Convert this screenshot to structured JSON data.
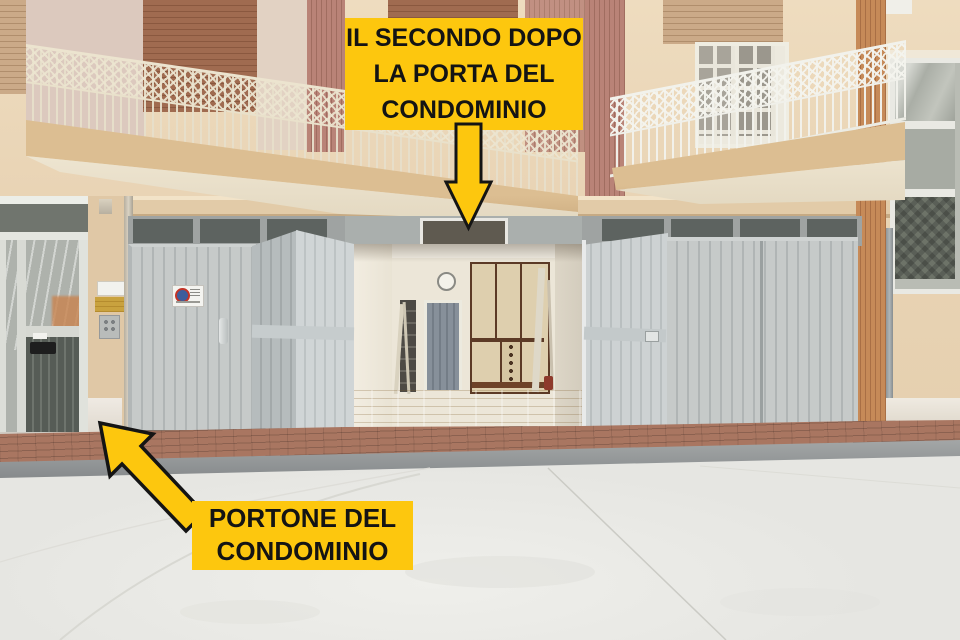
{
  "annotations": {
    "top_label": {
      "lines": [
        "IL SECONDO DOPO",
        "LA PORTA DEL",
        "CONDOMINIO"
      ]
    },
    "bottom_label": {
      "lines": [
        "PORTONE DEL",
        "CONDOMINIO"
      ]
    },
    "style": {
      "label_bg": "#fdc70e",
      "label_text": "#141414",
      "arrow_fill": "#fdc70e",
      "arrow_outline": "#141414"
    },
    "icons": {
      "top_arrow": "down-arrow-icon",
      "bottom_arrow": "up-left-arrow-icon"
    }
  },
  "scene": {
    "colors": {
      "facade": "#e9d4b5",
      "garage_door": "#c5c9c9",
      "shutter_brown": "#9e6a50",
      "brick_sidewalk": "#a97661",
      "concrete": "#e8e8e4",
      "wood_floor": "#c89e5a",
      "railing_cream": "#e3dbc6",
      "railing_white": "#efefea",
      "wood_slats": "#c08355"
    }
  }
}
